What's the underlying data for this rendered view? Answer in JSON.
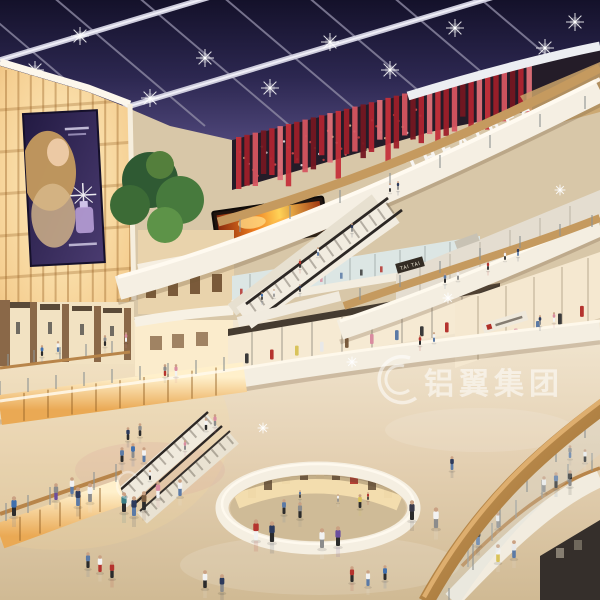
{
  "scene": {
    "type": "shopping-mall-atrium-interior-rendering",
    "signs": {
      "theatres_label": "THEATRES",
      "tai_tai_label": "TAI TAI"
    },
    "watermark": {
      "text": "铝翼集团"
    },
    "colors": {
      "sky_navy": "#211c3e",
      "beam_white": "#cdccdc",
      "theatre_red": "#b02430",
      "warm_glow": "#f5cf92",
      "amber_band": "#f0bc6e",
      "wood_rail": "#b8854a",
      "fascia_white": "#f5efe3",
      "floor_beige": "#e2d2b4",
      "screen_fire_orange": "#f07f1f",
      "ad_purple": "#3a2f5e"
    },
    "people": [
      [
        14,
        516,
        20,
        "#3f6fae",
        "#2b2b2b"
      ],
      [
        78,
        506,
        19,
        "#2c3a5c",
        "#5b7aa6"
      ],
      [
        90,
        502,
        19,
        "#f2f2f2",
        "#8c8c8c"
      ],
      [
        124,
        512,
        20,
        "#3a7f86",
        "#2b2b2b"
      ],
      [
        134,
        516,
        20,
        "#2c3a5c",
        "#5b7aa6"
      ],
      [
        144,
        510,
        19,
        "#7a5b3e",
        "#2b2b2b"
      ],
      [
        158,
        498,
        17,
        "#d98ca0",
        "#f2f2f2"
      ],
      [
        180,
        496,
        17,
        "#f2f2f2",
        "#5b7aa6"
      ],
      [
        256,
        540,
        21,
        "#b5332e",
        "#f2f2f2"
      ],
      [
        272,
        542,
        21,
        "#2c3a5c",
        "#2b2b2b"
      ],
      [
        322,
        548,
        20,
        "#f2f2f2",
        "#8c8c8c"
      ],
      [
        338,
        546,
        20,
        "#6a4e9e",
        "#2b2b2b"
      ],
      [
        300,
        518,
        16,
        "#8c8c8c",
        "#2b2b2b"
      ],
      [
        284,
        514,
        15,
        "#5b7aa6",
        "#2b2b2b"
      ],
      [
        360,
        508,
        14,
        "#d9c35a",
        "#2b2b2b"
      ],
      [
        412,
        520,
        20,
        "#3a3a4a",
        "#2b2b2b"
      ],
      [
        436,
        528,
        21,
        "#f2f2f2",
        "#8c8c8c"
      ],
      [
        452,
        470,
        14,
        "#2c3a5c",
        "#5b7aa6"
      ],
      [
        498,
        562,
        18,
        "#f2f2f2",
        "#d9c35a"
      ],
      [
        514,
        558,
        18,
        "#e8e8e8",
        "#5b7aa6"
      ],
      [
        205,
        588,
        18,
        "#f2f2f2",
        "#2b2b2b"
      ],
      [
        222,
        592,
        18,
        "#2c3a5c",
        "#8c8c8c"
      ],
      [
        100,
        572,
        17,
        "#f2f2f2",
        "#b5332e"
      ],
      [
        112,
        578,
        17,
        "#b5332e",
        "#2b2b2b"
      ],
      [
        88,
        568,
        16,
        "#5b7aa6",
        "#2b2b2b"
      ],
      [
        352,
        582,
        16,
        "#b5332e",
        "#2b2b2b"
      ],
      [
        368,
        586,
        16,
        "#f2f2f2",
        "#5b7aa6"
      ],
      [
        385,
        580,
        15,
        "#3f6fae",
        "#2b2b2b"
      ],
      [
        56,
        500,
        17,
        "#8c8c8c",
        "#6a4e9e"
      ],
      [
        72,
        494,
        17,
        "#f2f2f2",
        "#5b7aa6"
      ],
      [
        478,
        545,
        19,
        "#2b2b2b",
        "#5b7aa6"
      ],
      [
        498,
        528,
        16,
        "#f2f2f2",
        "#8c8c8c"
      ],
      [
        544,
        492,
        16,
        "#f2f2f2",
        "#8c8c8c"
      ],
      [
        556,
        488,
        16,
        "#5b7aa6",
        "#2b2b2b"
      ],
      [
        570,
        486,
        16,
        "#2b2b2b",
        "#8c8c8c"
      ],
      [
        585,
        462,
        13,
        "#f2f2f2",
        "#2b2b2b"
      ],
      [
        570,
        458,
        13,
        "#8c8c8c",
        "#5b7aa6"
      ],
      [
        420,
        345,
        10,
        "#b5332e",
        "#2b2b2b"
      ],
      [
        434,
        342,
        10,
        "#f2f2f2",
        "#5b7aa6"
      ],
      [
        540,
        325,
        10,
        "#2c3a5c",
        "#8c8c8c"
      ],
      [
        554,
        322,
        10,
        "#d98ca0",
        "#f2f2f2"
      ],
      [
        445,
        283,
        10,
        "#5b7aa6",
        "#2b2b2b"
      ],
      [
        458,
        280,
        10,
        "#f2f2f2",
        "#8c8c8c"
      ],
      [
        488,
        270,
        9,
        "#b5332e",
        "#2b2b2b"
      ],
      [
        505,
        260,
        9,
        "#f2f2f2",
        "#2b2b2b"
      ],
      [
        518,
        256,
        9,
        "#2c3a5c",
        "#5b7aa6"
      ],
      [
        262,
        300,
        8,
        "#3f6fae",
        "#2b2b2b"
      ],
      [
        274,
        297,
        8,
        "#f2f2f2",
        "#8c8c8c"
      ],
      [
        300,
        292,
        8,
        "#2c3a5c",
        "#2b2b2b"
      ],
      [
        390,
        192,
        9,
        "#f2f2f2",
        "#2b2b2b"
      ],
      [
        398,
        190,
        9,
        "#2c3a5c",
        "#8c8c8c"
      ],
      [
        42,
        356,
        11,
        "#3f6fae",
        "#2b2b2b"
      ],
      [
        58,
        352,
        11,
        "#f2f2f2",
        "#5b7aa6"
      ],
      [
        105,
        346,
        11,
        "#8c8c8c",
        "#2b2b2b"
      ],
      [
        126,
        342,
        10,
        "#d98ca0",
        "#f2f2f2"
      ],
      [
        165,
        376,
        12,
        "#8c8c8c",
        "#b5332e"
      ],
      [
        176,
        376,
        12,
        "#d98ca0",
        "#f2f2f2"
      ],
      [
        122,
        462,
        15,
        "#5b7aa6",
        "#2b2b2b"
      ],
      [
        133,
        458,
        15,
        "#3f6fae",
        "#8c8c8c"
      ],
      [
        144,
        462,
        15,
        "#f2f2f2",
        "#5b7aa6"
      ],
      [
        128,
        440,
        13,
        "#2c3a5c",
        "#2b2b2b"
      ],
      [
        140,
        436,
        13,
        "#8c8c8c",
        "#2b2b2b"
      ],
      [
        206,
        430,
        12,
        "#f2f2f2",
        "#2b2b2b"
      ],
      [
        215,
        426,
        12,
        "#d98ca0",
        "#8c8c8c"
      ],
      [
        300,
        268,
        9,
        "#b5332e",
        "#2b2b2b"
      ],
      [
        318,
        256,
        9,
        "#f2f2f2",
        "#5b7aa6"
      ],
      [
        352,
        232,
        9,
        "#2c3a5c",
        "#8c8c8c"
      ],
      [
        150,
        480,
        10,
        "#f2f2f2",
        "#2b2b2b"
      ],
      [
        185,
        450,
        10,
        "#d98ca0",
        "#8c8c8c"
      ],
      [
        300,
        498,
        8,
        "#5b7aa6",
        "#2b2b2b"
      ],
      [
        338,
        502,
        8,
        "#f2f2f2",
        "#8c8c8c"
      ],
      [
        368,
        500,
        8,
        "#b5332e",
        "#2b2b2b"
      ]
    ]
  }
}
